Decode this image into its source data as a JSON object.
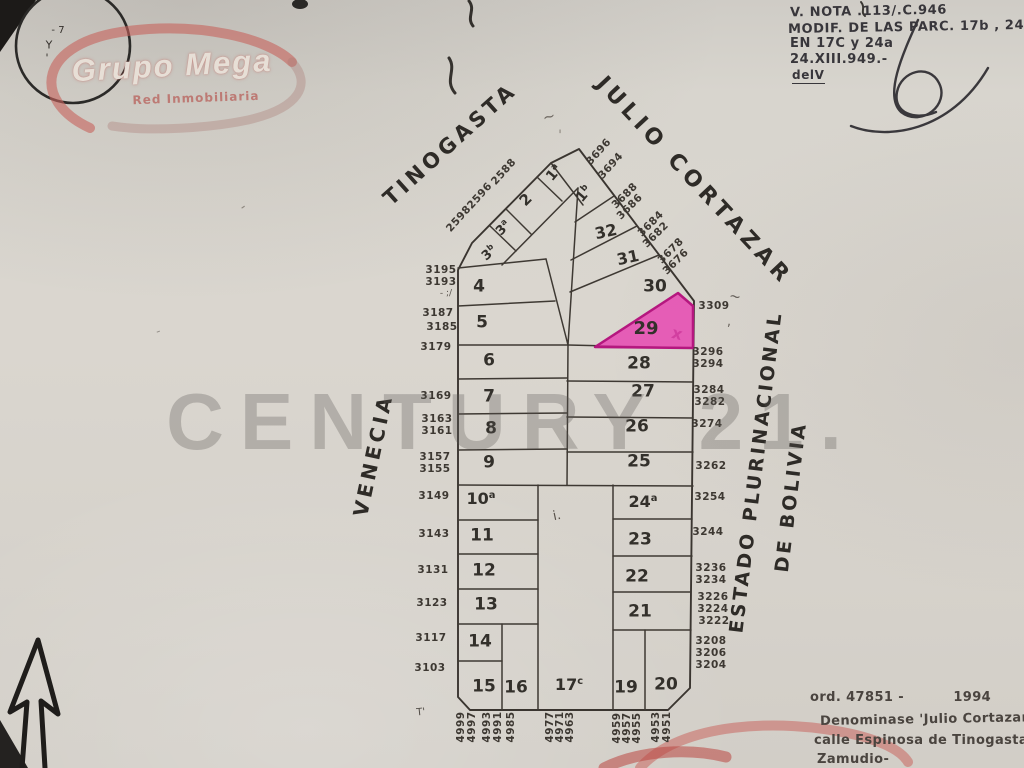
{
  "colors": {
    "paper": "#d8d5ce",
    "ink": "#35312c",
    "highlight_fill": "#e83bb0",
    "highlight_stroke": "#b5177f",
    "logo_red": "#c4645e",
    "watermark_gray": "#585652"
  },
  "logo_grupo_mega": {
    "title": "Grupo Mega",
    "subtitle": "Red Inmobiliaria"
  },
  "watermark": {
    "text": "CENTURY 21."
  },
  "streets": {
    "tinogasta": "TINOGASTA",
    "julio_cortazar": "JULIO CORTAZAR",
    "venecia": "VENECIA",
    "bolivia_line1": "ESTADO PLURINACIONAL",
    "bolivia_line2": "DE BOLIVIA"
  },
  "annotations": {
    "top_right": {
      "line1": "V. NOTA .113/.C.946",
      "line2": "MODIF. DE LAS PARC. 17b , 24",
      "line3": "EN 17C y 24a",
      "line4": "24.XIII.949.-",
      "line5": "delV"
    },
    "bottom_right": {
      "line1": "ord. 47851 -          1994",
      "line2": "Denominase 'Julio Cortazar' a",
      "line3": "calle Espinosa de Tinogasta",
      "line4": "Zamudio-"
    }
  },
  "highlighted_parcel": "29",
  "parcel_labels": [
    {
      "t": "4",
      "x": 479,
      "y": 287,
      "s": 17
    },
    {
      "t": "5",
      "x": 482,
      "y": 323,
      "s": 17
    },
    {
      "t": "6",
      "x": 489,
      "y": 361,
      "s": 17
    },
    {
      "t": "7",
      "x": 489,
      "y": 397,
      "s": 17
    },
    {
      "t": "8",
      "x": 491,
      "y": 429,
      "s": 17
    },
    {
      "t": "9",
      "x": 489,
      "y": 463,
      "s": 17
    },
    {
      "t": "10",
      "sup": "a",
      "x": 481,
      "y": 499,
      "s": 16
    },
    {
      "t": "11",
      "x": 482,
      "y": 536,
      "s": 17
    },
    {
      "t": "12",
      "x": 484,
      "y": 571,
      "s": 17
    },
    {
      "t": "13",
      "x": 486,
      "y": 605,
      "s": 17
    },
    {
      "t": "14",
      "x": 480,
      "y": 642,
      "s": 17
    },
    {
      "t": "15",
      "x": 484,
      "y": 687,
      "s": 17
    },
    {
      "t": "16",
      "x": 516,
      "y": 688,
      "s": 17
    },
    {
      "t": "17",
      "sup": "c",
      "x": 569,
      "y": 685,
      "s": 16
    },
    {
      "t": "19",
      "x": 626,
      "y": 688,
      "s": 17
    },
    {
      "t": "20",
      "x": 666,
      "y": 685,
      "s": 17
    },
    {
      "t": "21",
      "x": 640,
      "y": 612,
      "s": 17
    },
    {
      "t": "22",
      "x": 637,
      "y": 577,
      "s": 17
    },
    {
      "t": "23",
      "x": 640,
      "y": 540,
      "s": 17
    },
    {
      "t": "24",
      "sup": "a",
      "x": 643,
      "y": 502,
      "s": 16
    },
    {
      "t": "25",
      "x": 639,
      "y": 462,
      "s": 17
    },
    {
      "t": "26",
      "x": 637,
      "y": 427,
      "s": 17
    },
    {
      "t": "27",
      "x": 643,
      "y": 392,
      "s": 17
    },
    {
      "t": "28",
      "x": 639,
      "y": 364,
      "s": 17
    },
    {
      "t": "29",
      "x": 646,
      "y": 329,
      "s": 18
    },
    {
      "t": "30",
      "x": 655,
      "y": 287,
      "s": 17
    },
    {
      "t": "31",
      "x": 628,
      "y": 258,
      "r": -12,
      "s": 16
    },
    {
      "t": "32",
      "x": 606,
      "y": 232,
      "r": -12,
      "s": 16
    },
    {
      "t": "1",
      "sup": "b",
      "x": 584,
      "y": 194,
      "r": -50,
      "s": 14
    },
    {
      "t": "1",
      "sup": "a",
      "x": 554,
      "y": 173,
      "r": -50,
      "s": 14
    },
    {
      "t": "2",
      "x": 526,
      "y": 200,
      "r": -45,
      "s": 15
    },
    {
      "t": "3",
      "sup": "a",
      "x": 503,
      "y": 228,
      "r": -45,
      "s": 13
    },
    {
      "t": "3",
      "sup": "b",
      "x": 489,
      "y": 253,
      "r": -40,
      "s": 13
    }
  ],
  "boundary_numbers": [
    {
      "t": "3195",
      "x": 441,
      "y": 270
    },
    {
      "t": "3193",
      "x": 441,
      "y": 282
    },
    {
      "t": "3187",
      "x": 438,
      "y": 313,
      "w": "700"
    },
    {
      "t": "3185",
      "x": 442,
      "y": 327
    },
    {
      "t": "3179",
      "x": 436,
      "y": 347
    },
    {
      "t": "3169",
      "x": 436,
      "y": 396
    },
    {
      "t": "3163",
      "x": 437,
      "y": 419
    },
    {
      "t": "3161",
      "x": 437,
      "y": 431
    },
    {
      "t": "3157",
      "x": 435,
      "y": 457
    },
    {
      "t": "3155",
      "x": 435,
      "y": 469
    },
    {
      "t": "3149",
      "x": 434,
      "y": 496
    },
    {
      "t": "3143",
      "x": 434,
      "y": 534
    },
    {
      "t": "3131",
      "x": 433,
      "y": 570
    },
    {
      "t": "3123",
      "x": 432,
      "y": 603
    },
    {
      "t": "3117",
      "x": 431,
      "y": 638
    },
    {
      "t": "3103",
      "x": 430,
      "y": 668
    },
    {
      "t": "3309",
      "x": 714,
      "y": 306
    },
    {
      "t": "3296",
      "x": 708,
      "y": 352
    },
    {
      "t": "3294",
      "x": 708,
      "y": 364
    },
    {
      "t": "3284",
      "x": 709,
      "y": 390
    },
    {
      "t": "3282",
      "x": 710,
      "y": 402
    },
    {
      "t": "3274",
      "x": 707,
      "y": 424
    },
    {
      "t": "3262",
      "x": 711,
      "y": 466
    },
    {
      "t": "3254",
      "x": 710,
      "y": 497
    },
    {
      "t": "3244",
      "x": 708,
      "y": 532
    },
    {
      "t": "3236",
      "x": 711,
      "y": 568
    },
    {
      "t": "3234",
      "x": 711,
      "y": 580
    },
    {
      "t": "3226",
      "x": 713,
      "y": 597
    },
    {
      "t": "3224",
      "x": 713,
      "y": 609
    },
    {
      "t": "3222",
      "x": 714,
      "y": 621
    },
    {
      "t": "3208",
      "x": 711,
      "y": 641
    },
    {
      "t": "3206",
      "x": 711,
      "y": 653
    },
    {
      "t": "3204",
      "x": 711,
      "y": 665
    },
    {
      "t": "2598",
      "x": 459,
      "y": 219,
      "r": -48
    },
    {
      "t": "2596",
      "x": 480,
      "y": 196,
      "r": -48
    },
    {
      "t": "2588",
      "x": 504,
      "y": 172,
      "r": -48
    },
    {
      "t": "3696",
      "x": 599,
      "y": 152,
      "r": -48
    },
    {
      "t": "3694",
      "x": 611,
      "y": 166,
      "r": -48
    },
    {
      "t": "3688",
      "x": 625,
      "y": 196,
      "r": -45
    },
    {
      "t": "3686",
      "x": 630,
      "y": 207,
      "r": -45
    },
    {
      "t": "3684",
      "x": 651,
      "y": 224,
      "r": -45
    },
    {
      "t": "3682",
      "x": 656,
      "y": 235,
      "r": -45
    },
    {
      "t": "3678",
      "x": 671,
      "y": 251,
      "r": -45
    },
    {
      "t": "3676",
      "x": 676,
      "y": 262,
      "r": -45
    },
    {
      "t": "4999",
      "x": 461,
      "y": 727,
      "r": -90
    },
    {
      "t": "4997",
      "x": 472,
      "y": 727,
      "r": -90
    },
    {
      "t": "4993",
      "x": 487,
      "y": 727,
      "r": -90
    },
    {
      "t": "4991",
      "x": 498,
      "y": 727,
      "r": -90
    },
    {
      "t": "4985",
      "x": 511,
      "y": 727,
      "r": -90
    },
    {
      "t": "4977",
      "x": 550,
      "y": 727,
      "r": -90
    },
    {
      "t": "4971",
      "x": 560,
      "y": 727,
      "r": -90
    },
    {
      "t": "4963",
      "x": 570,
      "y": 727,
      "r": -90
    },
    {
      "t": "4959",
      "x": 617,
      "y": 728,
      "r": -90
    },
    {
      "t": "4957",
      "x": 627,
      "y": 728,
      "r": -90
    },
    {
      "t": "4955",
      "x": 637,
      "y": 728,
      "r": -90
    },
    {
      "t": "4953",
      "x": 656,
      "y": 727,
      "r": -90
    },
    {
      "t": "4951",
      "x": 667,
      "y": 727,
      "r": -90
    }
  ],
  "pencil_marks": [
    {
      "t": "x",
      "x": 677,
      "y": 334,
      "r": 15,
      "s": 16,
      "c": "#d23fa0",
      "w": "700"
    },
    {
      "t": "- ;/",
      "x": 446,
      "y": 294,
      "s": 9,
      "c": "#5a544d"
    },
    {
      "t": "~",
      "x": 549,
      "y": 117,
      "r": -15,
      "s": 15,
      "c": "#6b655e"
    },
    {
      "t": "'",
      "x": 560,
      "y": 136,
      "s": 13,
      "c": "#8a847c"
    },
    {
      "t": "~",
      "x": 735,
      "y": 297,
      "r": 10,
      "s": 14,
      "c": "#5f5953"
    },
    {
      "t": ",",
      "x": 729,
      "y": 322,
      "s": 13,
      "c": "#6b655e"
    },
    {
      "t": "i.",
      "x": 557,
      "y": 516,
      "r": -12,
      "s": 13,
      "c": "#575049"
    },
    {
      "t": "T'",
      "x": 421,
      "y": 713,
      "r": -6,
      "s": 10,
      "c": "#4e4943"
    },
    {
      "t": "-",
      "x": 243,
      "y": 207,
      "r": -35,
      "s": 14,
      "c": "#8d877f"
    },
    {
      "t": "-",
      "x": 158,
      "y": 331,
      "r": -20,
      "s": 12,
      "c": "#95908a"
    },
    {
      "t": "- 7",
      "x": 58,
      "y": 31,
      "s": 10,
      "c": "#332f2b"
    },
    {
      "t": "Y",
      "x": 49,
      "y": 45,
      "s": 11,
      "c": "#332f2b"
    },
    {
      "t": "'",
      "x": 47,
      "y": 58,
      "s": 11,
      "c": "#332f2b"
    }
  ]
}
